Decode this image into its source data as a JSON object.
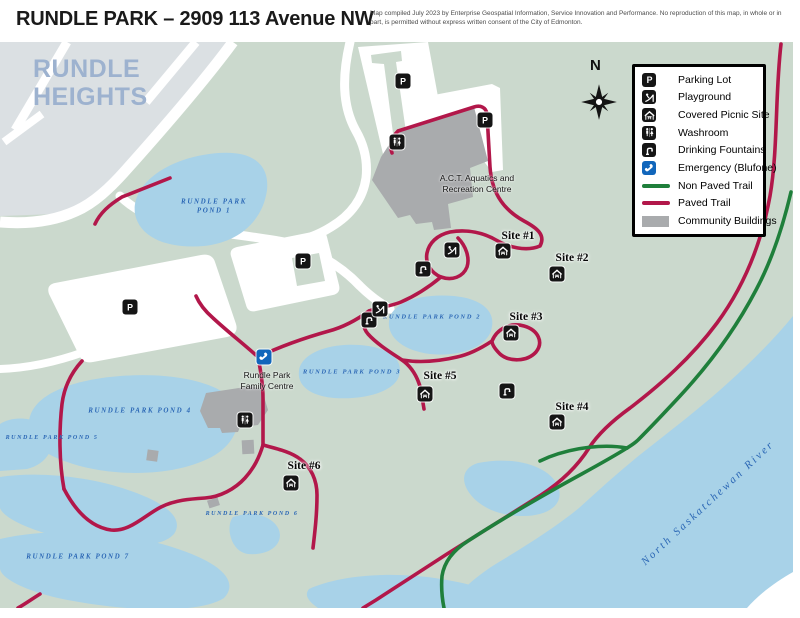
{
  "header": {
    "title": "RUNDLE PARK – 2909 113 Avenue NW",
    "disclaimer": "Map compiled July 2023 by Enterprise Geospatial Information, Service Innovation and Performance. No reproduction of this map, in whole or in part, is permitted without express written consent of the City of Edmonton."
  },
  "compass": {
    "label": "N"
  },
  "neighbourhood_label": "RUNDLE HEIGHTS",
  "river_label": "North Saskatchewan River",
  "legend": {
    "items": [
      {
        "icon": "parking-icon",
        "label": "Parking Lot"
      },
      {
        "icon": "playground-icon",
        "label": "Playground"
      },
      {
        "icon": "picnic-icon",
        "label": "Covered Picnic Site"
      },
      {
        "icon": "washroom-icon",
        "label": "Washroom"
      },
      {
        "icon": "fountain-icon",
        "label": "Drinking Fountains"
      },
      {
        "icon": "blufone-icon",
        "label": "Emergency (Blufone)"
      },
      {
        "icon": "nonpaved-line",
        "label": "Non Paved Trail"
      },
      {
        "icon": "paved-line",
        "label": "Paved Trail"
      },
      {
        "icon": "building-swatch",
        "label": "Community Buildings"
      }
    ]
  },
  "labels": {
    "ponds": [
      {
        "lines": [
          "RUNDLE PARK",
          "POND 1"
        ],
        "x": 214,
        "y": 207,
        "size": 7
      },
      {
        "lines": [
          "RUNDLE PARK POND 2"
        ],
        "x": 432,
        "y": 318,
        "size": 6.5
      },
      {
        "lines": [
          "RUNDLE PARK POND 3"
        ],
        "x": 352,
        "y": 373,
        "size": 6.5
      },
      {
        "lines": [
          "RUNDLE PARK POND 4"
        ],
        "x": 140,
        "y": 411,
        "size": 7
      },
      {
        "lines": [
          "RUNDLE PARK POND 5"
        ],
        "x": 52,
        "y": 438,
        "size": 6
      },
      {
        "lines": [
          "RUNDLE PARK POND 6"
        ],
        "x": 252,
        "y": 514,
        "size": 6
      },
      {
        "lines": [
          "RUNDLE PARK POND 7"
        ],
        "x": 78,
        "y": 557,
        "size": 7
      }
    ],
    "sites": [
      {
        "text": "Site #1",
        "x": 518,
        "y": 236
      },
      {
        "text": "Site #2",
        "x": 572,
        "y": 258
      },
      {
        "text": "Site #3",
        "x": 526,
        "y": 317
      },
      {
        "text": "Site #4",
        "x": 572,
        "y": 407
      },
      {
        "text": "Site #5",
        "x": 440,
        "y": 376
      },
      {
        "text": "Site #6",
        "x": 304,
        "y": 466
      }
    ],
    "buildings": [
      {
        "lines": [
          "A.C.T. Aquatics and",
          "Recreation Centre"
        ],
        "x": 477,
        "y": 184
      },
      {
        "lines": [
          "Rundle Park",
          "Family Centre"
        ],
        "x": 267,
        "y": 381
      }
    ]
  },
  "markers": [
    {
      "type": "parking",
      "x": 403,
      "y": 81
    },
    {
      "type": "parking",
      "x": 485,
      "y": 120
    },
    {
      "type": "parking",
      "x": 130,
      "y": 307
    },
    {
      "type": "parking",
      "x": 303,
      "y": 261
    },
    {
      "type": "washroom",
      "x": 397,
      "y": 142
    },
    {
      "type": "washroom",
      "x": 245,
      "y": 420
    },
    {
      "type": "fountain",
      "x": 423,
      "y": 269
    },
    {
      "type": "fountain",
      "x": 369,
      "y": 320
    },
    {
      "type": "fountain",
      "x": 507,
      "y": 391
    },
    {
      "type": "playground",
      "x": 452,
      "y": 250
    },
    {
      "type": "playground",
      "x": 380,
      "y": 309
    },
    {
      "type": "picnic",
      "x": 503,
      "y": 251
    },
    {
      "type": "picnic",
      "x": 557,
      "y": 274
    },
    {
      "type": "picnic",
      "x": 511,
      "y": 333
    },
    {
      "type": "picnic",
      "x": 425,
      "y": 394
    },
    {
      "type": "picnic",
      "x": 557,
      "y": 422
    },
    {
      "type": "picnic",
      "x": 291,
      "y": 483
    },
    {
      "type": "blufone",
      "x": 264,
      "y": 357
    }
  ],
  "colors": {
    "park": "#cbd9cd",
    "water": "#a8d2e8",
    "residential": "#dbe0e3",
    "building": "#a9abad",
    "paved_trail": "#b2174a",
    "non_paved_trail": "#1f7f3b",
    "emergency_blue": "#1166bb"
  }
}
